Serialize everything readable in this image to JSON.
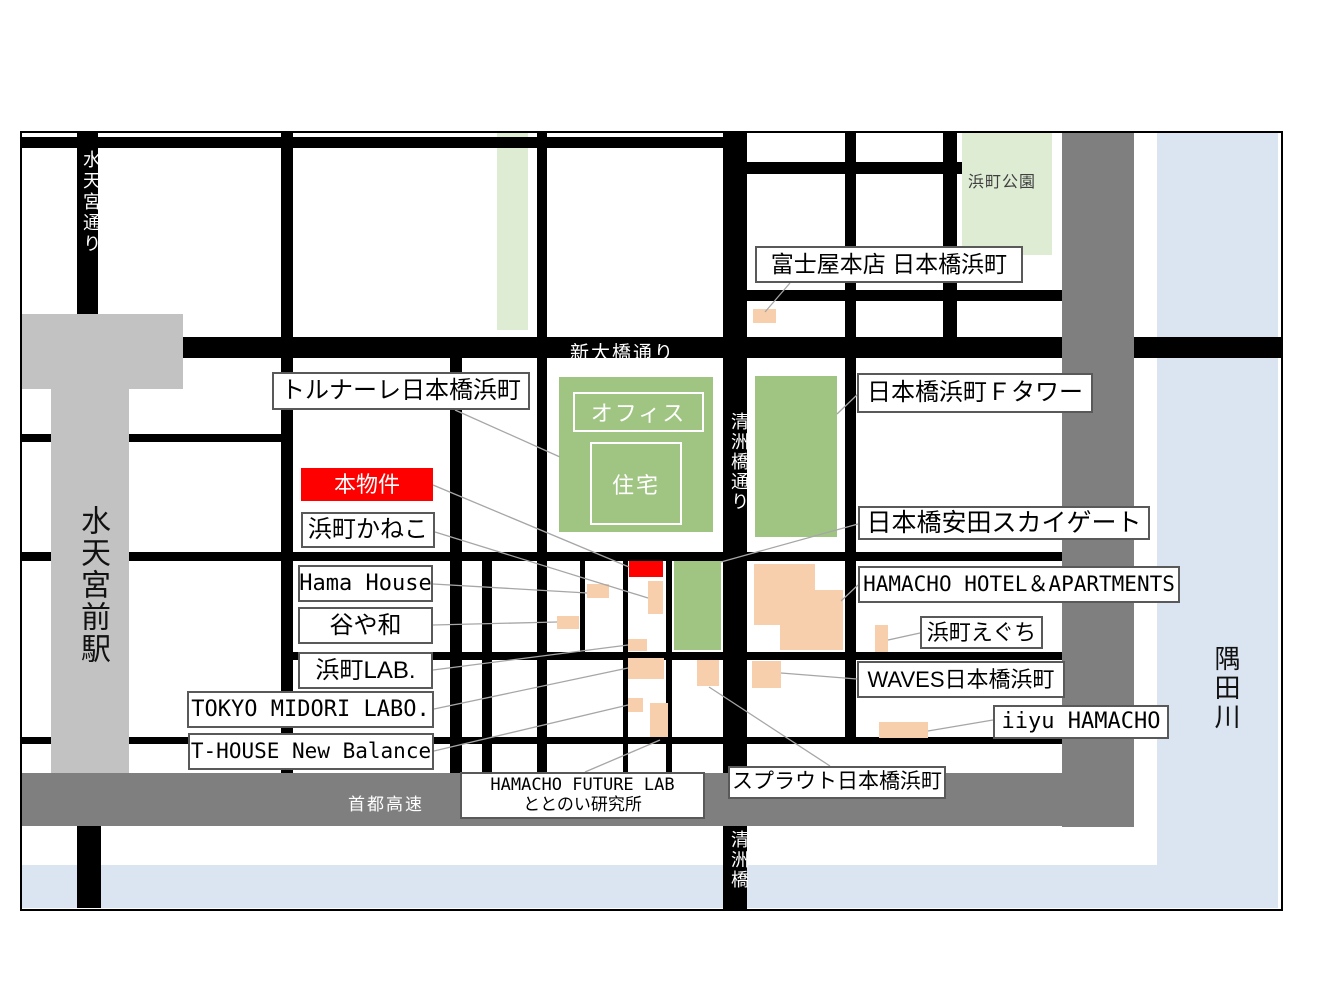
{
  "map": {
    "origin": {
      "x": 22,
      "y": 133
    },
    "rivers": [
      {
        "id": "sumida-river-vertical",
        "x": 1157,
        "y": 133,
        "w": 121,
        "h": 775,
        "color": "#dbe5f1"
      },
      {
        "id": "sumida-river-bottom",
        "x": 20,
        "y": 865,
        "w": 1258,
        "h": 43,
        "color": "#dbe5f1"
      }
    ],
    "greens": [
      {
        "id": "green-strip-north",
        "x": 497,
        "y": 133,
        "w": 31,
        "h": 197,
        "tone": "pale"
      },
      {
        "id": "park-hamacho",
        "x": 962,
        "y": 133,
        "w": 90,
        "h": 122,
        "tone": "pale"
      },
      {
        "id": "bldg-tornare",
        "x": 559,
        "y": 377,
        "w": 154,
        "h": 155,
        "tone": "deep"
      },
      {
        "id": "bldg-f-tower",
        "x": 755,
        "y": 376,
        "w": 82,
        "h": 161,
        "tone": "deep"
      },
      {
        "id": "bldg-yasuda-skygate",
        "x": 674,
        "y": 561,
        "w": 47,
        "h": 89,
        "tone": "deep"
      }
    ],
    "roads": [
      {
        "id": "road-h-north-west",
        "x": 20,
        "y": 137,
        "w": 727,
        "h": 11
      },
      {
        "id": "road-h-north-east",
        "x": 723,
        "y": 162,
        "w": 239,
        "h": 12
      },
      {
        "id": "road-h-east-2",
        "x": 723,
        "y": 290,
        "w": 339,
        "h": 11
      },
      {
        "id": "road-shin-ohashi-dori",
        "x": 20,
        "y": 337,
        "w": 1263,
        "h": 21
      },
      {
        "id": "road-h-station-south",
        "x": 20,
        "y": 434,
        "w": 261,
        "h": 8
      },
      {
        "id": "road-h-middle",
        "x": 20,
        "y": 552,
        "w": 1042,
        "h": 9
      },
      {
        "id": "road-h-lower",
        "x": 281,
        "y": 652,
        "w": 781,
        "h": 8
      },
      {
        "id": "road-h-bottom",
        "x": 20,
        "y": 737,
        "w": 1042,
        "h": 7
      },
      {
        "id": "road-v-suitengu-dori",
        "x": 77,
        "y": 133,
        "w": 21,
        "h": 225
      },
      {
        "id": "road-v-suitengu-south",
        "x": 77,
        "y": 826,
        "w": 24,
        "h": 82
      },
      {
        "id": "road-v-2",
        "x": 281,
        "y": 133,
        "w": 12,
        "h": 640
      },
      {
        "id": "road-v-3",
        "x": 450,
        "y": 358,
        "w": 12,
        "h": 415
      },
      {
        "id": "road-v-4",
        "x": 537,
        "y": 133,
        "w": 10,
        "h": 640
      },
      {
        "id": "road-v-kiyosubashi-dori",
        "x": 723,
        "y": 133,
        "w": 24,
        "h": 778
      },
      {
        "id": "road-v-6",
        "x": 845,
        "y": 133,
        "w": 11,
        "h": 610
      },
      {
        "id": "road-v-7",
        "x": 943,
        "y": 133,
        "w": 14,
        "h": 204
      },
      {
        "id": "road-v-8",
        "x": 482,
        "y": 561,
        "w": 10,
        "h": 212
      },
      {
        "id": "road-v-9",
        "x": 580,
        "y": 561,
        "w": 5,
        "h": 92
      },
      {
        "id": "road-v-10",
        "x": 623,
        "y": 561,
        "w": 5,
        "h": 212
      },
      {
        "id": "road-v-11",
        "x": 666,
        "y": 561,
        "w": 6,
        "h": 212
      }
    ],
    "zones": [
      {
        "id": "station-suitengumae-upper",
        "x": 22,
        "y": 314,
        "w": 161,
        "h": 75,
        "color": "#c2c2c2"
      },
      {
        "id": "station-suitengumae-stem",
        "x": 51,
        "y": 389,
        "w": 78,
        "h": 437,
        "color": "#c2c2c2"
      },
      {
        "id": "shuto-expressway-band",
        "x": 20,
        "y": 773,
        "w": 1114,
        "h": 53,
        "color": "#7f7f7f"
      },
      {
        "id": "riverside-gray-band",
        "x": 1062,
        "y": 133,
        "w": 72,
        "h": 694,
        "color": "#7f7f7f"
      }
    ],
    "buildings": [
      {
        "id": "bldg-fujiya",
        "x": 753,
        "y": 309,
        "w": 23,
        "h": 14,
        "color": "orange"
      },
      {
        "id": "bldg-hama-house",
        "x": 587,
        "y": 584,
        "w": 22,
        "h": 14,
        "color": "orange"
      },
      {
        "id": "bldg-subject-property",
        "x": 629,
        "y": 561,
        "w": 34,
        "h": 16,
        "color": "red"
      },
      {
        "id": "bldg-hamacho-kaneko",
        "x": 648,
        "y": 581,
        "w": 15,
        "h": 33,
        "color": "orange"
      },
      {
        "id": "bldg-taniyawa",
        "x": 557,
        "y": 616,
        "w": 22,
        "h": 13,
        "color": "orange"
      },
      {
        "id": "bldg-hamacho-lab",
        "x": 628,
        "y": 639,
        "w": 19,
        "h": 12,
        "color": "orange"
      },
      {
        "id": "bldg-tokyo-midori-labo",
        "x": 628,
        "y": 658,
        "w": 36,
        "h": 21,
        "color": "orange"
      },
      {
        "id": "bldg-t-house",
        "x": 628,
        "y": 698,
        "w": 15,
        "h": 14,
        "color": "orange"
      },
      {
        "id": "bldg-future-lab",
        "x": 650,
        "y": 703,
        "w": 18,
        "h": 34,
        "color": "orange"
      },
      {
        "id": "bldg-sprout",
        "x": 697,
        "y": 660,
        "w": 22,
        "h": 26,
        "color": "orange"
      },
      {
        "id": "bldg-waves",
        "x": 752,
        "y": 661,
        "w": 29,
        "h": 27,
        "color": "orange"
      },
      {
        "id": "bldg-hamacho-eguchi",
        "x": 875,
        "y": 625,
        "w": 13,
        "h": 27,
        "color": "orange"
      },
      {
        "id": "bldg-iiyu-hamacho",
        "x": 879,
        "y": 722,
        "w": 49,
        "h": 16,
        "color": "orange"
      },
      {
        "id": "bldg-hamacho-hotel-a",
        "x": 754,
        "y": 564,
        "w": 61,
        "h": 61,
        "color": "orange"
      },
      {
        "id": "bldg-hamacho-hotel-b",
        "x": 815,
        "y": 590,
        "w": 28,
        "h": 60,
        "color": "orange"
      },
      {
        "id": "bldg-hamacho-hotel-c",
        "x": 780,
        "y": 625,
        "w": 35,
        "h": 25,
        "color": "orange"
      }
    ],
    "tornare_inner": [
      {
        "id": "tornare-office-box",
        "text": "オフィス",
        "x": 573,
        "y": 392,
        "w": 127,
        "h": 36
      },
      {
        "id": "tornare-jutaku-box",
        "text": "住宅",
        "x": 590,
        "y": 442,
        "w": 88,
        "h": 79
      }
    ],
    "leaders": [
      {
        "id": "leader-fujiya",
        "x1": 790,
        "y1": 283,
        "x2": 765,
        "y2": 312
      },
      {
        "id": "leader-tornare",
        "x1": 455,
        "y1": 410,
        "x2": 560,
        "y2": 457
      },
      {
        "id": "leader-subject",
        "x1": 433,
        "y1": 485,
        "x2": 629,
        "y2": 567
      },
      {
        "id": "leader-kaneko",
        "x1": 435,
        "y1": 532,
        "x2": 648,
        "y2": 598
      },
      {
        "id": "leader-hama-house",
        "x1": 433,
        "y1": 584,
        "x2": 587,
        "y2": 593
      },
      {
        "id": "leader-taniyawa",
        "x1": 433,
        "y1": 625,
        "x2": 557,
        "y2": 622
      },
      {
        "id": "leader-hamacho-lab",
        "x1": 433,
        "y1": 670,
        "x2": 628,
        "y2": 645
      },
      {
        "id": "leader-midori",
        "x1": 434,
        "y1": 709,
        "x2": 628,
        "y2": 668
      },
      {
        "id": "leader-t-house",
        "x1": 434,
        "y1": 751,
        "x2": 628,
        "y2": 705
      },
      {
        "id": "leader-f-tower",
        "x1": 858,
        "y1": 394,
        "x2": 837,
        "y2": 414
      },
      {
        "id": "leader-yasuda",
        "x1": 858,
        "y1": 524,
        "x2": 721,
        "y2": 562
      },
      {
        "id": "leader-hotel",
        "x1": 858,
        "y1": 585,
        "x2": 841,
        "y2": 601
      },
      {
        "id": "leader-eguchi",
        "x1": 920,
        "y1": 633,
        "x2": 888,
        "y2": 640
      },
      {
        "id": "leader-waves",
        "x1": 857,
        "y1": 679,
        "x2": 781,
        "y2": 673
      },
      {
        "id": "leader-iiyu",
        "x1": 993,
        "y1": 720,
        "x2": 928,
        "y2": 731
      },
      {
        "id": "leader-future-lab",
        "x1": 585,
        "y1": 772,
        "x2": 660,
        "y2": 740
      },
      {
        "id": "leader-sprout",
        "x1": 830,
        "y1": 766,
        "x2": 709,
        "y2": 687
      }
    ],
    "place_labels": [
      {
        "id": "label-fujiya",
        "text": "富士屋本店 日本橋浜町",
        "x": 755,
        "y": 246,
        "w": 268,
        "h": 37,
        "fs": 23,
        "variant": "white",
        "mono": false
      },
      {
        "id": "label-tornare",
        "text": "トルナーレ日本橋浜町",
        "x": 272,
        "y": 372,
        "w": 258,
        "h": 38,
        "fs": 24,
        "variant": "white",
        "mono": false
      },
      {
        "id": "label-subject-property",
        "text": "本物件",
        "x": 301,
        "y": 468,
        "w": 132,
        "h": 33,
        "fs": 22,
        "variant": "red",
        "mono": false
      },
      {
        "id": "label-hamacho-kaneko",
        "text": "浜町かねこ",
        "x": 301,
        "y": 512,
        "w": 134,
        "h": 36,
        "fs": 24,
        "variant": "white",
        "mono": false
      },
      {
        "id": "label-hama-house",
        "text": "Hama House",
        "x": 298,
        "y": 565,
        "w": 135,
        "h": 37,
        "fs": 22,
        "variant": "white",
        "mono": true
      },
      {
        "id": "label-taniyawa",
        "text": "谷や和",
        "x": 298,
        "y": 607,
        "w": 135,
        "h": 37,
        "fs": 24,
        "variant": "white",
        "mono": false
      },
      {
        "id": "label-hamacho-lab",
        "text": "浜町LAB.",
        "x": 298,
        "y": 652,
        "w": 135,
        "h": 37,
        "fs": 24,
        "variant": "white",
        "mono": false
      },
      {
        "id": "label-tokyo-midori-labo",
        "text": "TOKYO MIDORI LABO.",
        "x": 187,
        "y": 691,
        "w": 247,
        "h": 37,
        "fs": 22,
        "variant": "white",
        "mono": true
      },
      {
        "id": "label-t-house",
        "text": "T-HOUSE New Balance",
        "x": 188,
        "y": 733,
        "w": 246,
        "h": 37,
        "fs": 21,
        "variant": "white",
        "mono": true
      },
      {
        "id": "label-f-tower",
        "text": "日本橋浜町Ｆタワー",
        "x": 857,
        "y": 373,
        "w": 236,
        "h": 40,
        "fs": 24,
        "variant": "white",
        "mono": false
      },
      {
        "id": "label-yasuda-skygate",
        "text": "日本橋安田スカイゲート",
        "x": 858,
        "y": 506,
        "w": 292,
        "h": 34,
        "fs": 25,
        "variant": "white",
        "mono": false
      },
      {
        "id": "label-hamacho-hotel",
        "text": "HAMACHO HOTEL＆APARTMENTS",
        "x": 858,
        "y": 566,
        "w": 322,
        "h": 37,
        "fs": 21,
        "variant": "white",
        "mono": true
      },
      {
        "id": "label-hamacho-eguchi",
        "text": "浜町えぐち",
        "x": 920,
        "y": 616,
        "w": 123,
        "h": 33,
        "fs": 22,
        "variant": "white",
        "mono": false
      },
      {
        "id": "label-waves",
        "text": "WAVES日本橋浜町",
        "x": 857,
        "y": 661,
        "w": 208,
        "h": 37,
        "fs": 22,
        "variant": "white",
        "mono": false
      },
      {
        "id": "label-iiyu-hamacho",
        "text": "iiyu HAMACHO",
        "x": 993,
        "y": 705,
        "w": 176,
        "h": 34,
        "fs": 22,
        "variant": "white",
        "mono": true
      },
      {
        "id": "label-hamacho-future-lab",
        "lines": [
          "HAMACHO FUTURE LAB",
          "ととのい研究所"
        ],
        "x": 460,
        "y": 772,
        "w": 245,
        "h": 47,
        "fs": 17,
        "variant": "white",
        "mono": true
      },
      {
        "id": "label-sprout",
        "text": "スプラウト日本橋浜町",
        "x": 728,
        "y": 766,
        "w": 218,
        "h": 33,
        "fs": 21,
        "variant": "white",
        "mono": false
      }
    ],
    "map_texts": [
      {
        "id": "road-name-shin-ohashi",
        "text": "新大橋通り",
        "x": 570,
        "y": 338,
        "size": 19,
        "color": "#ffffff",
        "dir": "h",
        "ls": 2
      },
      {
        "id": "road-name-suitengu-dori",
        "text": "水天宮通り",
        "x": 78,
        "y": 150,
        "size": 18,
        "color": "#ffffff",
        "dir": "v",
        "ls": 3
      },
      {
        "id": "road-name-kiyosubashi-dori",
        "text": "清洲橋通り",
        "x": 726,
        "y": 412,
        "size": 18,
        "color": "#ffffff",
        "dir": "v",
        "ls": 2
      },
      {
        "id": "road-name-kiyosubashi",
        "text": "清洲橋",
        "x": 726,
        "y": 830,
        "size": 18,
        "color": "#ffffff",
        "dir": "v",
        "ls": 2
      },
      {
        "id": "road-name-shuto-expressway",
        "text": "首都高速",
        "x": 348,
        "y": 790,
        "size": 17,
        "color": "#ffffff",
        "dir": "h",
        "ls": 2
      },
      {
        "id": "station-name-suitengumae",
        "text": "水天宮前駅",
        "x": 70,
        "y": 505,
        "size": 30,
        "color": "#111111",
        "dir": "v",
        "ls": 2
      },
      {
        "id": "river-name-sumida",
        "text": "隅田川",
        "x": 1208,
        "y": 645,
        "size": 26,
        "color": "#111111",
        "dir": "v",
        "ls": 3
      },
      {
        "id": "park-name-hamacho",
        "text": "浜町公園",
        "x": 968,
        "y": 168,
        "size": 16,
        "color": "#404040",
        "dir": "h",
        "ls": 1
      }
    ]
  }
}
